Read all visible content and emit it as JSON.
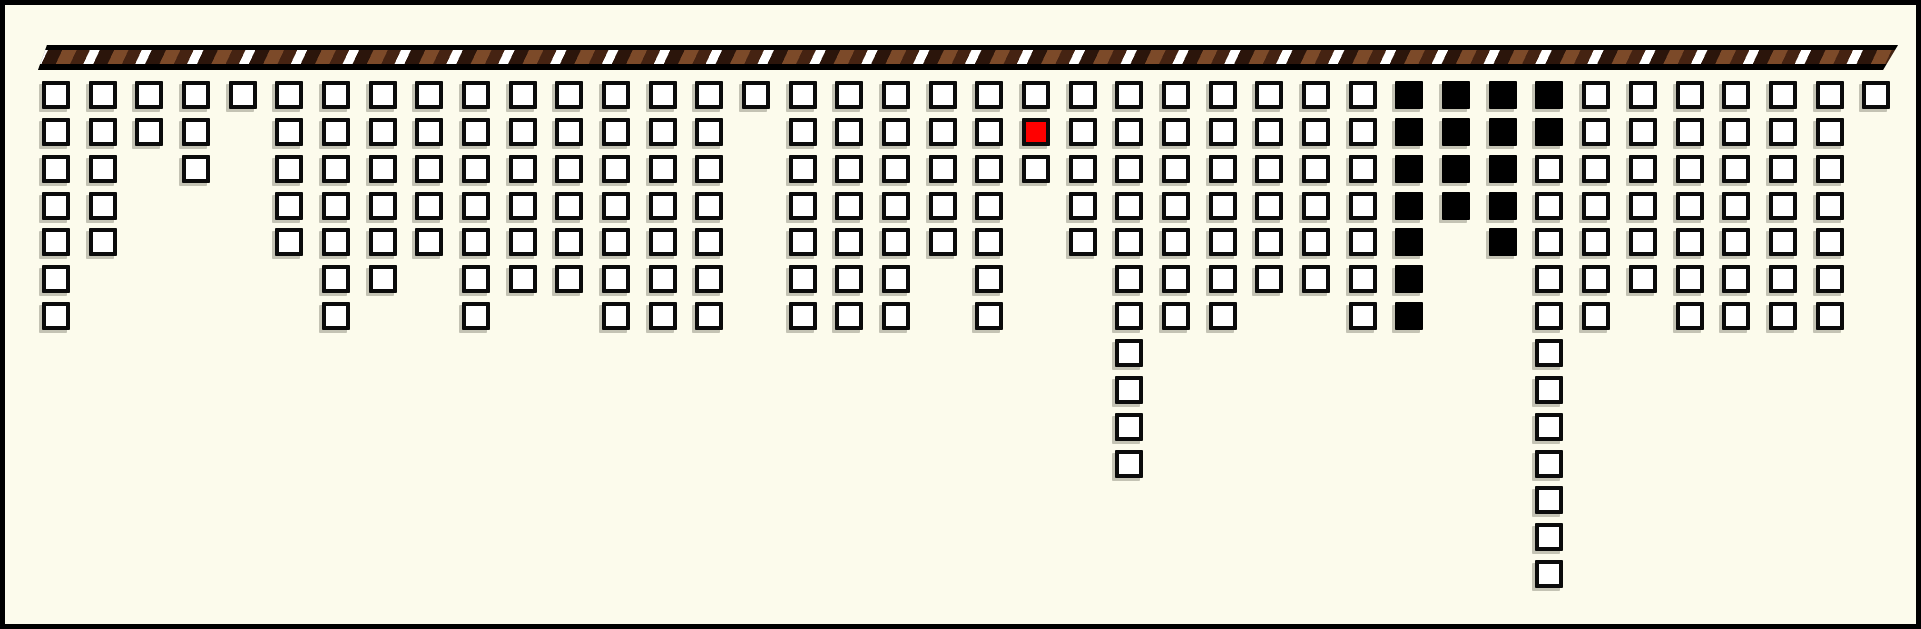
{
  "scene": {
    "background_color": "#FCFBEC",
    "frame_color": "#000000",
    "frame_thickness_px": 5
  },
  "rope": {
    "x": 33,
    "y": 40,
    "width": 1860,
    "height": 25,
    "edge_color": "#000000",
    "stripe_angle_deg": 115,
    "stripe_colors": {
      "white": "#FFFFFF",
      "dark": "#2B150B",
      "brown": "#7C4A29",
      "dark_brown": "#452312"
    },
    "stripe_widths_px": {
      "white": 9,
      "dark": 13,
      "brown": 13,
      "dark_brown": 12
    }
  },
  "grid": {
    "columns": 40,
    "col_pitch": 46.67,
    "row_pitch": 36.85,
    "first_col_left": 37,
    "first_row_top": 76,
    "square_size": 28,
    "square_border_color": "#0B0B0B",
    "square_fill_color": "#FFFFFF",
    "shadow_color": "rgba(150,150,135,0.55)"
  },
  "special_colors": {
    "red": "#FF0000",
    "black": "#000000"
  },
  "columns": [
    {
      "col": 1,
      "count": 7
    },
    {
      "col": 2,
      "count": 5
    },
    {
      "col": 3,
      "count": 2
    },
    {
      "col": 4,
      "count": 3
    },
    {
      "col": 5,
      "count": 1
    },
    {
      "col": 6,
      "count": 5
    },
    {
      "col": 7,
      "count": 7
    },
    {
      "col": 8,
      "count": 6
    },
    {
      "col": 9,
      "count": 5
    },
    {
      "col": 10,
      "count": 7
    },
    {
      "col": 11,
      "count": 6
    },
    {
      "col": 12,
      "count": 6
    },
    {
      "col": 13,
      "count": 7
    },
    {
      "col": 14,
      "count": 7
    },
    {
      "col": 15,
      "count": 7
    },
    {
      "col": 16,
      "count": 1
    },
    {
      "col": 17,
      "count": 7
    },
    {
      "col": 18,
      "count": 7
    },
    {
      "col": 19,
      "count": 7
    },
    {
      "col": 20,
      "count": 5
    },
    {
      "col": 21,
      "count": 7
    },
    {
      "col": 22,
      "count": 3,
      "red_rows": [
        2
      ]
    },
    {
      "col": 23,
      "count": 5
    },
    {
      "col": 24,
      "count": 11
    },
    {
      "col": 25,
      "count": 7
    },
    {
      "col": 26,
      "count": 7
    },
    {
      "col": 27,
      "count": 6
    },
    {
      "col": 28,
      "count": 6
    },
    {
      "col": 29,
      "count": 7
    },
    {
      "col": 30,
      "count": 7,
      "black_rows": [
        1,
        2,
        3,
        4,
        5,
        6,
        7
      ]
    },
    {
      "col": 31,
      "count": 4,
      "black_rows": [
        1,
        2,
        3,
        4
      ]
    },
    {
      "col": 32,
      "count": 5,
      "black_rows": [
        1,
        2,
        3,
        4,
        5
      ]
    },
    {
      "col": 33,
      "count": 14,
      "black_rows": [
        1,
        2
      ]
    },
    {
      "col": 34,
      "count": 7
    },
    {
      "col": 35,
      "count": 6
    },
    {
      "col": 36,
      "count": 7
    },
    {
      "col": 37,
      "count": 7
    },
    {
      "col": 38,
      "count": 7
    },
    {
      "col": 39,
      "count": 7
    },
    {
      "col": 40,
      "count": 1
    }
  ]
}
